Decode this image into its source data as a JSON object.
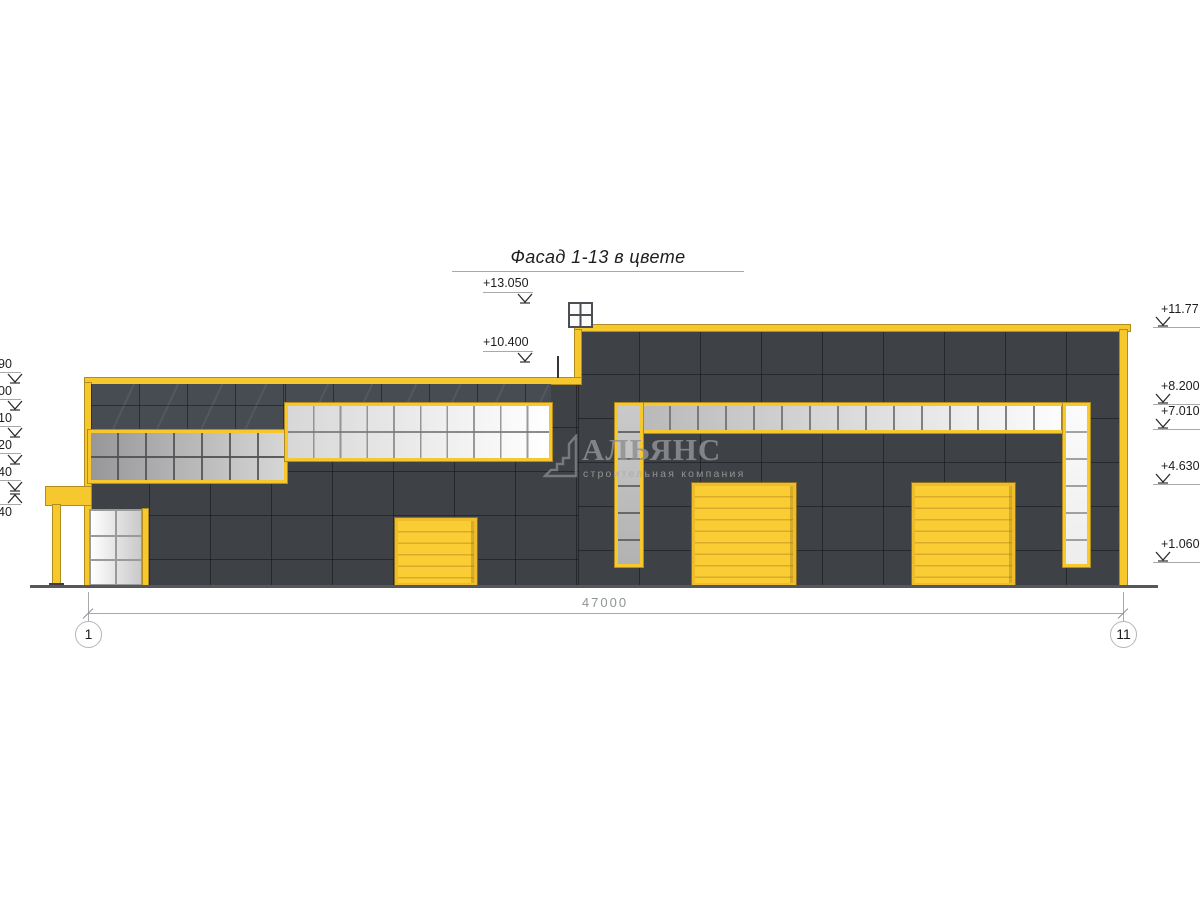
{
  "title": "Фасад 1-13 в цвете",
  "marks": {
    "top": [
      {
        "label": "+13.050"
      },
      {
        "label": "+10.400"
      }
    ],
    "right": [
      {
        "label": "+11.77"
      },
      {
        "label": "+8.200"
      },
      {
        "label": "+7.010"
      },
      {
        "label": "+4.630"
      },
      {
        "label": "+1.060"
      }
    ],
    "left": [
      {
        "label": "90"
      },
      {
        "label": "00"
      },
      {
        "label": "10"
      },
      {
        "label": "20"
      },
      {
        "label": "40"
      },
      {
        "label": "40"
      }
    ]
  },
  "dimension": {
    "total": "47000"
  },
  "axes": {
    "left": "1",
    "right": "11"
  },
  "watermark": {
    "company": "АЛЬЯНС",
    "tagline": "строительная компания"
  },
  "colors": {
    "accent_yellow": "#f7c72e",
    "door_yellow": "#f9cd33",
    "door_slat_line": "#dcaa2b",
    "wall_dark": "#3e4146",
    "glazing_dark": "#474b52",
    "ground": "#54575b",
    "dim_gray": "#a6aaad",
    "text_dark": "#1d1d1d"
  }
}
